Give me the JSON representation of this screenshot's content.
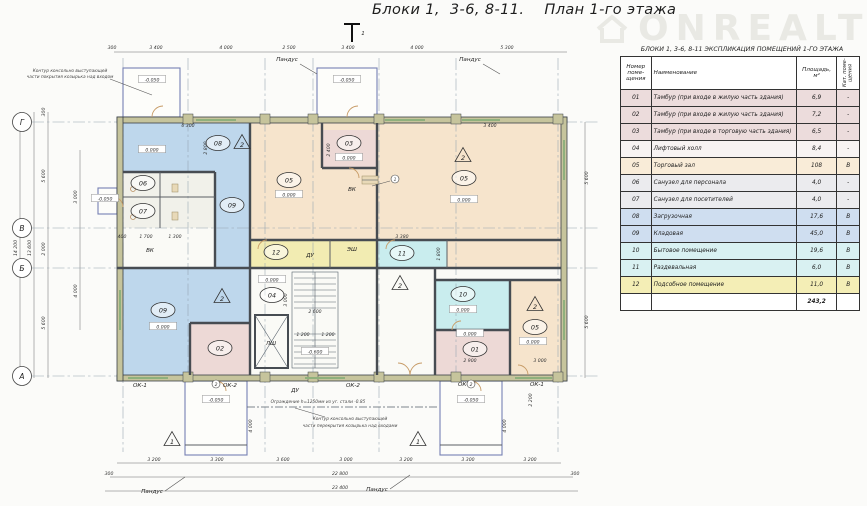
{
  "title": "Блоки 1,  3-6, 8-11.    План 1-го этажа",
  "watermark": "ONREALT",
  "table": {
    "title": "БЛОКИ 1,  3-6, 8-11   ЭКСПЛИКАЦИЯ ПОМЕЩЕНИЙ 1-ГО ЭТАЖА",
    "headers": {
      "num": "Номер поме- щения",
      "name": "Наименование",
      "area": "Площадь, м²",
      "cat": "Кат. поме- щения"
    },
    "rows": [
      {
        "num": "01",
        "name": "Тамбур (при входе в жилую часть здания)",
        "area": "6,9",
        "cat": "-",
        "color": "#ecdcdc"
      },
      {
        "num": "02",
        "name": "Тамбур (при входе в жилую часть здания)",
        "area": "7,2",
        "cat": "-",
        "color": "#ecdcdc"
      },
      {
        "num": "03",
        "name": "Тамбур (при входе в торговую часть здания)",
        "area": "6,5",
        "cat": "-",
        "color": "#ecdcdc"
      },
      {
        "num": "04",
        "name": "Лифтовый холл",
        "area": "8,4",
        "cat": "-",
        "color": "#f7f3f2"
      },
      {
        "num": "05",
        "name": "Торговый зал",
        "area": "108",
        "cat": "В",
        "color": "#f9ecd8"
      },
      {
        "num": "06",
        "name": "Санузел  для персонала",
        "area": "4,0",
        "cat": "-",
        "color": "#ebebee"
      },
      {
        "num": "07",
        "name": "Санузел  для посетителей",
        "area": "4,0",
        "cat": "-",
        "color": "#ebebee"
      },
      {
        "num": "08",
        "name": "Загрузочная",
        "area": "17,6",
        "cat": "В",
        "color": "#cfdef0"
      },
      {
        "num": "09",
        "name": "Кладовая",
        "area": "45,0",
        "cat": "В",
        "color": "#cfdef0"
      },
      {
        "num": "10",
        "name": "Бытовое помещение",
        "area": "19,6",
        "cat": "В",
        "color": "#d9f1f2"
      },
      {
        "num": "11",
        "name": "Раздевальная",
        "area": "6,0",
        "cat": "В",
        "color": "#d9f1f2"
      },
      {
        "num": "12",
        "name": "Подсобное помещение",
        "area": "11,0",
        "cat": "В",
        "color": "#f4eeb6"
      }
    ],
    "total": "243,2"
  },
  "colors": {
    "blue": "#bed7ec",
    "peach": "#f6e4cc",
    "pink": "#edd9d6",
    "cyan": "#c9edee",
    "yellow": "#f2ecb2",
    "core": "#fafaf6",
    "san": "#f1f1ea"
  },
  "plan": {
    "axes": [
      {
        "label": "Г",
        "y": 122
      },
      {
        "label": "В",
        "y": 228
      },
      {
        "label": "Б",
        "y": 268
      },
      {
        "label": "А",
        "y": 376
      }
    ],
    "rooms": [
      {
        "num": "08",
        "x": 218,
        "y": 143
      },
      {
        "num": "06",
        "x": 143,
        "y": 183
      },
      {
        "num": "07",
        "x": 143,
        "y": 211
      },
      {
        "num": "09",
        "x": 232,
        "y": 205
      },
      {
        "num": "05",
        "x": 289,
        "y": 180
      },
      {
        "num": "03",
        "x": 349,
        "y": 143
      },
      {
        "num": "05",
        "x": 464,
        "y": 178
      },
      {
        "num": "12",
        "x": 276,
        "y": 252
      },
      {
        "num": "11",
        "x": 402,
        "y": 253
      },
      {
        "num": "04",
        "x": 272,
        "y": 295
      },
      {
        "num": "09",
        "x": 163,
        "y": 310
      },
      {
        "num": "02",
        "x": 220,
        "y": 348
      },
      {
        "num": "10",
        "x": 463,
        "y": 294
      },
      {
        "num": "01",
        "x": 475,
        "y": 349
      },
      {
        "num": "05",
        "x": 535,
        "y": 327
      }
    ],
    "elevs": [
      {
        "t": "0.000",
        "x": 152,
        "y": 150
      },
      {
        "t": "0.000",
        "x": 289,
        "y": 195
      },
      {
        "t": "0.000",
        "x": 349,
        "y": 158
      },
      {
        "t": "0.000",
        "x": 464,
        "y": 200
      },
      {
        "t": "0.000",
        "x": 272,
        "y": 280
      },
      {
        "t": "0.000",
        "x": 163,
        "y": 327
      },
      {
        "t": "0.000",
        "x": 463,
        "y": 310
      },
      {
        "t": "0.000",
        "x": 470,
        "y": 334
      },
      {
        "t": "0.000",
        "x": 533,
        "y": 342
      },
      {
        "t": "-0.050",
        "x": 152,
        "y": 80
      },
      {
        "t": "-0.050",
        "x": 347,
        "y": 80
      },
      {
        "t": "-0.050",
        "x": 105,
        "y": 199
      },
      {
        "t": "-0.050",
        "x": 216,
        "y": 400
      },
      {
        "t": "-0.050",
        "x": 471,
        "y": 400
      },
      {
        "t": "-0.600",
        "x": 315,
        "y": 352
      }
    ],
    "tris": [
      {
        "n": "2",
        "x": 242,
        "y": 143
      },
      {
        "n": "2",
        "x": 463,
        "y": 156
      },
      {
        "n": "2",
        "x": 535,
        "y": 305
      },
      {
        "n": "2",
        "x": 222,
        "y": 297
      },
      {
        "n": "2",
        "x": 400,
        "y": 284
      },
      {
        "n": "1",
        "x": 172,
        "y": 440
      },
      {
        "n": "1",
        "x": 418,
        "y": 440
      }
    ],
    "circles": [
      {
        "n": "2",
        "x": 216,
        "y": 384
      },
      {
        "n": "2",
        "x": 471,
        "y": 384
      },
      {
        "n": "1",
        "x": 395,
        "y": 179
      }
    ],
    "texts": [
      {
        "t": "300",
        "x": 112,
        "y": 49
      },
      {
        "t": "3 400",
        "x": 156,
        "y": 49
      },
      {
        "t": "4 000",
        "x": 226,
        "y": 49
      },
      {
        "t": "2 500",
        "x": 289,
        "y": 49
      },
      {
        "t": "3 400",
        "x": 348,
        "y": 49
      },
      {
        "t": "4 000",
        "x": 417,
        "y": 49
      },
      {
        "t": "5 300",
        "x": 507,
        "y": 49
      },
      {
        "t": "3 200",
        "x": 154,
        "y": 461
      },
      {
        "t": "3 300",
        "x": 217,
        "y": 461
      },
      {
        "t": "3 600",
        "x": 283,
        "y": 461
      },
      {
        "t": "3 000",
        "x": 346,
        "y": 461
      },
      {
        "t": "3 200",
        "x": 406,
        "y": 461
      },
      {
        "t": "3 300",
        "x": 468,
        "y": 461
      },
      {
        "t": "3 200",
        "x": 530,
        "y": 461
      },
      {
        "t": "22 800",
        "x": 340,
        "y": 475
      },
      {
        "t": "23 400",
        "x": 340,
        "y": 489
      },
      {
        "t": "300",
        "x": 109,
        "y": 475
      },
      {
        "t": "300",
        "x": 575,
        "y": 475
      },
      {
        "t": "14 200",
        "x": 17,
        "y": 248,
        "r": -90
      },
      {
        "t": "13 600",
        "x": 31,
        "y": 248,
        "r": -90
      },
      {
        "t": "5 600",
        "x": 45,
        "y": 176,
        "r": -90
      },
      {
        "t": "2 000",
        "x": 45,
        "y": 249,
        "r": -90
      },
      {
        "t": "5 600",
        "x": 45,
        "y": 323,
        "r": -90
      },
      {
        "t": "300",
        "x": 45,
        "y": 112,
        "r": -90
      },
      {
        "t": "3 000",
        "x": 77,
        "y": 197,
        "r": -90
      },
      {
        "t": "4 000",
        "x": 77,
        "y": 291,
        "r": -90
      },
      {
        "t": "5 600",
        "x": 588,
        "y": 178,
        "r": -90
      },
      {
        "t": "5 600",
        "x": 588,
        "y": 322,
        "r": -90
      },
      {
        "t": "2 200",
        "x": 532,
        "y": 400,
        "r": -90
      },
      {
        "t": "4 000",
        "x": 252,
        "y": 426,
        "r": -90
      },
      {
        "t": "4 000",
        "x": 506,
        "y": 426,
        "r": -90
      },
      {
        "t": "6 300",
        "x": 188,
        "y": 127
      },
      {
        "t": "3 400",
        "x": 490,
        "y": 127
      },
      {
        "t": "2 800",
        "x": 207,
        "y": 148,
        "r": -90
      },
      {
        "t": "2 400",
        "x": 330,
        "y": 150,
        "r": -90
      },
      {
        "t": "400",
        "x": 122,
        "y": 238
      },
      {
        "t": "1 700",
        "x": 146,
        "y": 238
      },
      {
        "t": "1 300",
        "x": 175,
        "y": 238
      },
      {
        "t": "2 600",
        "x": 315,
        "y": 313
      },
      {
        "t": "1 200",
        "x": 303,
        "y": 336
      },
      {
        "t": "1 200",
        "x": 328,
        "y": 336
      },
      {
        "t": "3 000",
        "x": 287,
        "y": 300,
        "r": -90
      },
      {
        "t": "3 380",
        "x": 402,
        "y": 238
      },
      {
        "t": "2 900",
        "x": 470,
        "y": 362
      },
      {
        "t": "3 000",
        "x": 540,
        "y": 362
      },
      {
        "t": "1 800",
        "x": 440,
        "y": 254,
        "r": -90
      },
      {
        "t": "ВК",
        "x": 150,
        "y": 252,
        "c": "l"
      },
      {
        "t": "ВК",
        "x": 352,
        "y": 191,
        "c": "l"
      },
      {
        "t": "ДУ",
        "x": 310,
        "y": 257,
        "c": "l"
      },
      {
        "t": "ЭШ",
        "x": 352,
        "y": 251,
        "c": "l"
      },
      {
        "t": "ЛШ",
        "x": 271,
        "y": 345,
        "c": "l"
      },
      {
        "t": "ДУ",
        "x": 295,
        "y": 392,
        "c": "l"
      },
      {
        "t": "ОК-1",
        "x": 140,
        "y": 387,
        "c": "l"
      },
      {
        "t": "ОК-2",
        "x": 230,
        "y": 387,
        "c": "l"
      },
      {
        "t": "ОК-2",
        "x": 353,
        "y": 387,
        "c": "l"
      },
      {
        "t": "ОК-2",
        "x": 465,
        "y": 386,
        "c": "l"
      },
      {
        "t": "ОК-1",
        "x": 537,
        "y": 386,
        "c": "l"
      },
      {
        "t": "Пандус",
        "x": 287,
        "y": 61,
        "c": "l"
      },
      {
        "t": "Пандус",
        "x": 470,
        "y": 61,
        "c": "l"
      },
      {
        "t": "Пандус",
        "x": 152,
        "y": 493,
        "c": "l"
      },
      {
        "t": "Пандус",
        "x": 377,
        "y": 491,
        "c": "l"
      },
      {
        "t": "1",
        "x": 363,
        "y": 35,
        "c": "l"
      },
      {
        "t": "Контур консольно выступающей",
        "x": 70,
        "y": 72,
        "c": "n"
      },
      {
        "t": "части покрытия козырька над входом",
        "x": 70,
        "y": 78,
        "c": "n"
      },
      {
        "t": "Ограждение h=1250мм из уг. стали  -0.85",
        "x": 318,
        "y": 403,
        "c": "n"
      },
      {
        "t": "Контур консольно выступающей",
        "x": 350,
        "y": 420,
        "c": "n"
      },
      {
        "t": "части перекрытия козырька над входами",
        "x": 350,
        "y": 427,
        "c": "n"
      }
    ]
  }
}
